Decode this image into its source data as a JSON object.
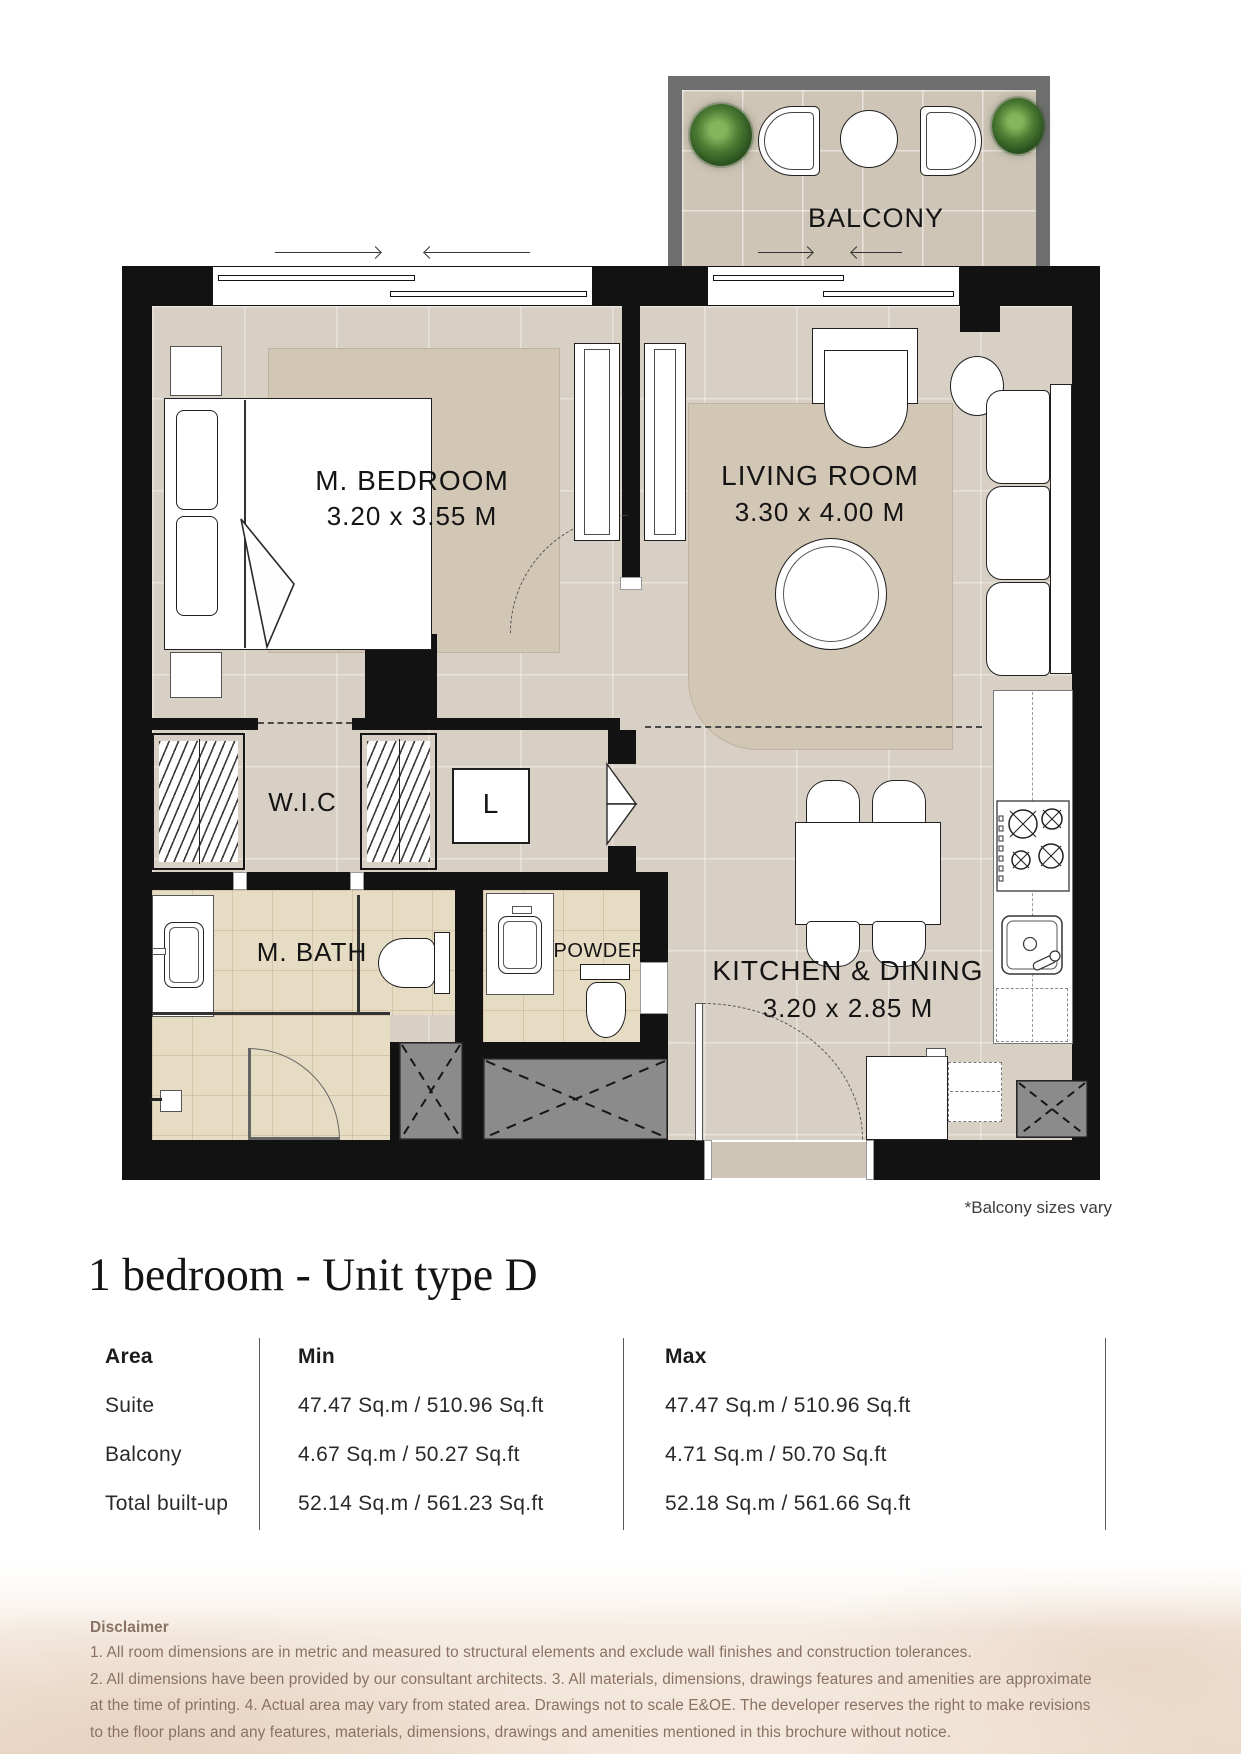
{
  "page": {
    "width": 1241,
    "height": 1754
  },
  "plan": {
    "balcony": {
      "label": "BALCONY"
    },
    "bedroom": {
      "label": "M. BEDROOM",
      "dims": "3.20 x 3.55 M"
    },
    "living": {
      "label": "LIVING ROOM",
      "dims": "3.30 x 4.00 M"
    },
    "wic": {
      "label": "W.I.C"
    },
    "laundry": {
      "label": "L"
    },
    "mbath": {
      "label": "M. BATH"
    },
    "powder": {
      "label": "POWDER"
    },
    "kitchen": {
      "label": "KITCHEN & DINING",
      "dims": "3.20 x 2.85 M"
    },
    "note": "*Balcony sizes vary"
  },
  "unit": {
    "title": "1 bedroom - Unit type D"
  },
  "area_table": {
    "columns": [
      "Area",
      "Min",
      "Max"
    ],
    "rows": [
      {
        "area": "Suite",
        "min": "47.47 Sq.m / 510.96 Sq.ft",
        "max": "47.47 Sq.m / 510.96 Sq.ft"
      },
      {
        "area": "Balcony",
        "min": "4.67 Sq.m / 50.27 Sq.ft",
        "max": "4.71 Sq.m / 50.70 Sq.ft"
      },
      {
        "area": "Total built-up",
        "min": "52.14 Sq.m / 561.23 Sq.ft",
        "max": "52.18 Sq.m / 561.66 Sq.ft"
      }
    ]
  },
  "disclaimer": {
    "heading": "Disclaimer",
    "lines": [
      "1. All room dimensions are in metric and measured to structural elements and exclude wall finishes and construction tolerances.",
      "2. All dimensions have been provided by our consultant architects. 3. All materials, dimensions, drawings features and amenities are approximate",
      "at the time of printing. 4. Actual area may vary from stated area. Drawings not to scale E&OE. The developer reserves the right to make revisions",
      "to the floor plans and any features, materials, dimensions, drawings and amenities mentioned in this brochure without notice."
    ]
  },
  "colors": {
    "wall": "#121212",
    "balcony_wall": "#6f6f6f",
    "floor": "#d9d0c5",
    "bath_tile": "#e6dcc4",
    "rug": "#d2c6b4",
    "shaft": "#8b8b8b",
    "plant": "#3c6b2b",
    "disclaimer_text": "#8a7164"
  }
}
